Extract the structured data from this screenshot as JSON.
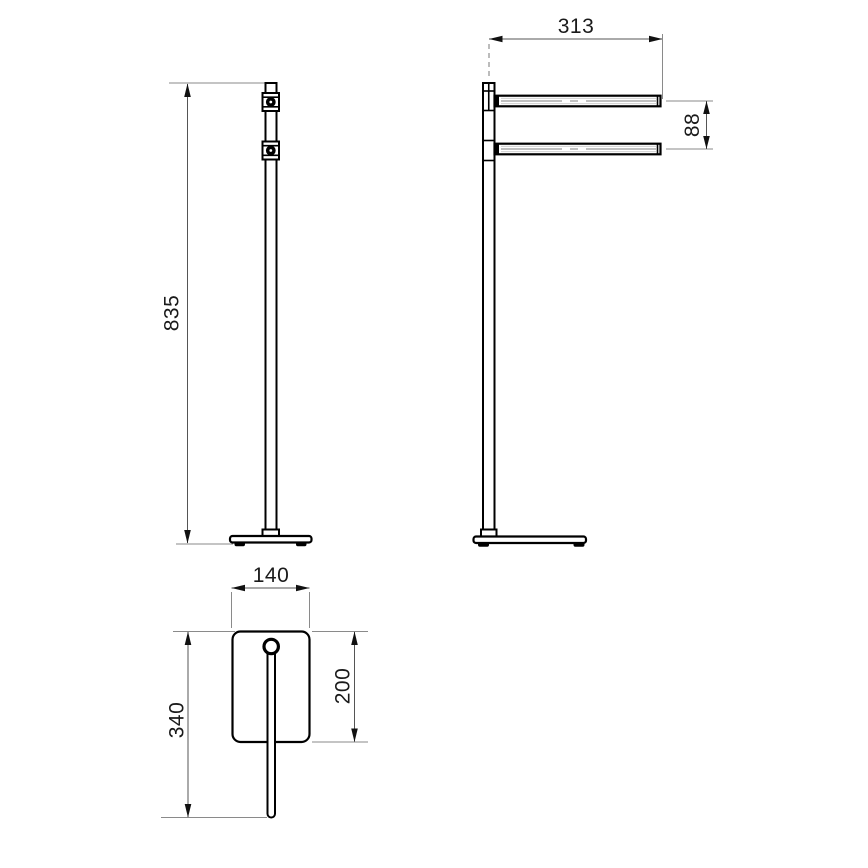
{
  "drawing": {
    "kind": "freestanding towel rack technical drawing, three orthographic views",
    "colors": {
      "background": "#ffffff",
      "geometry_line": "#000000",
      "dimension_line": "#555555",
      "extension_line": "#8a8a8a",
      "text": "#1a1a1a"
    }
  },
  "views": {
    "front": {
      "label": "front-view",
      "dims": {
        "height": "835"
      }
    },
    "side": {
      "label": "side-view",
      "dims": {
        "bar_length": "313",
        "bar_spacing": "88"
      }
    },
    "top": {
      "label": "top-view",
      "dims": {
        "base_width": "140",
        "base_depth": "200",
        "overall_depth": "340"
      }
    }
  }
}
